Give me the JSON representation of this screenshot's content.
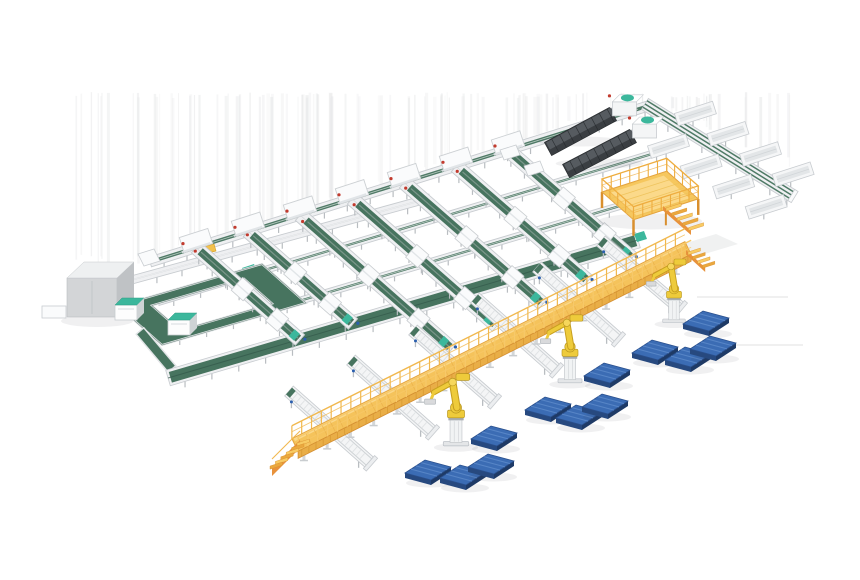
{
  "meta": {
    "canvas_width": 860,
    "canvas_height": 580,
    "background": "#ffffff"
  },
  "palette": {
    "belt_green": "#47745f",
    "belt_green_dark": "#33584a",
    "belt_green_mid": "#3f6a56",
    "teal": "#3cb79c",
    "teal_dark": "#2d9a82",
    "frame_white": "#eff0f2",
    "frame_light": "#fafbfc",
    "frame_stroke": "#c8ccd0",
    "leg_gray": "#b9bdc1",
    "rail_gray": "#d8dbde",
    "roller_gray": "#dfe2e4",
    "walkway_yellow": "#f5c35b",
    "walkway_edge": "#e3a33f",
    "walkway_light": "#fbda8e",
    "walkway_skirt": "#e9ae47",
    "walkway_skirt_line": "#d99b33",
    "stair_orange": "#e8923c",
    "robot_yellow": "#eecb3b",
    "robot_deep": "#c79f1f",
    "robot_outline": "#b8961f",
    "robot_joint": "#f6d75c",
    "pallet_blue": "#3b6cb4",
    "pallet_blue_light": "#5c8aca",
    "pallet_side": "#27497f",
    "pallet_side_dark": "#1e3a66",
    "loader_dark": "#3a3e42",
    "loader_top": "#565b60",
    "loader_line": "#24282b",
    "cabinet_gray": "#d3d5d7",
    "cabinet_top": "#eef0f1",
    "cabinet_side": "#bfc2c5",
    "dot_red": "#c23b2e",
    "dot_blue": "#2b5fae",
    "streak": "#e7e8e9",
    "floor_line": "#dcdcdc",
    "shadow_patch": "#f0f1f1",
    "soft_shadow": "rgba(60,70,80,0.08)"
  },
  "scene": {
    "iso": {
      "u": [
        0.952,
        -0.306
      ],
      "v": [
        0.75,
        0.66
      ]
    },
    "streaks": {
      "seed": 13,
      "count": 120,
      "x_min": 62,
      "x_max": 790,
      "y_top": 92
    },
    "trunks": [
      {
        "p1": [
          150,
          262
        ],
        "p2": [
          648,
          106
        ],
        "w": 10,
        "green": 3.5,
        "leg_step": 24,
        "leg_len": 6
      },
      {
        "p1": [
          158,
          302
        ],
        "p2": [
          672,
          148
        ],
        "w": 7,
        "green": 2.2,
        "leg_step": 28,
        "leg_len": 5
      },
      {
        "p1": [
          164,
          341
        ],
        "p2": [
          640,
          200
        ],
        "w": 7,
        "green": 2.2,
        "leg_step": 28,
        "leg_len": 5
      },
      {
        "p1": [
          117,
          284
        ],
        "p2": [
          430,
          198
        ],
        "w": 8,
        "green": 0,
        "leg_step": 26,
        "leg_len": 6
      }
    ],
    "t3": {
      "p1": [
        168,
        378
      ],
      "p2": [
        638,
        240
      ],
      "w": 16,
      "leg_step": 28
    },
    "loop": {
      "corners": [
        [
          118,
          306
        ],
        [
          262,
          264
        ],
        [
          306,
          303
        ],
        [
          162,
          345
        ]
      ],
      "band": 11
    },
    "bridge": {
      "p1": [
        140,
        331
      ],
      "p2": [
        172,
        369
      ],
      "w": 10
    },
    "teal_cabinets": [
      [
        115,
        305
      ],
      [
        168,
        320
      ]
    ],
    "cabinet": {
      "x": 67,
      "y": 278,
      "w": 50,
      "h": 39,
      "dx": 17,
      "dy": 16
    },
    "stub": {
      "x": 42,
      "y": 306,
      "w": 24,
      "h": 12
    },
    "yellow_box": [
      203,
      247
    ],
    "lanes": [
      {
        "h": [
          196,
          247.6
        ],
        "e": [
          300,
          340
        ]
      },
      {
        "h": [
          248,
          231.3
        ],
        "e": [
          353,
          324
        ]
      },
      {
        "h": [
          300,
          215.1
        ],
        "e": [
          452,
          349
        ]
      },
      {
        "h": [
          352,
          198.8
        ],
        "e": [
          497,
          326
        ]
      },
      {
        "h": [
          404,
          182.6
        ],
        "e": [
          543,
          304
        ]
      },
      {
        "h": [
          456,
          166.3
        ],
        "e": [
          588,
          281
        ]
      },
      {
        "h": [
          508,
          150.0
        ],
        "e": [
          632,
          258
        ]
      }
    ],
    "modules_small": [
      [
        500,
        150
      ],
      [
        524,
        166
      ]
    ],
    "loaders": [
      {
        "tail": [
          548,
          149
        ],
        "head": [
          613,
          114
        ]
      },
      {
        "tail": [
          566,
          171
        ],
        "head": [
          633,
          136
        ]
      }
    ],
    "spine": {
      "p1": [
        645,
        104
      ],
      "p2": [
        793,
        196
      ],
      "w": 13,
      "tracks": 3
    },
    "troughs": {
      "upper_t": [
        0.3,
        0.52,
        0.74,
        0.96
      ],
      "lower_t": [
        0.24,
        0.46,
        0.68,
        0.9
      ],
      "len": 40,
      "w": 13,
      "up_off": [
        6,
        -18
      ],
      "low_off": [
        -12,
        20
      ]
    },
    "platform": {
      "a": [
        602,
        192
      ],
      "ulen": 68,
      "vlen": 42,
      "rail_h": 13,
      "leg_h": 16
    },
    "walkway": {
      "p1": [
        295,
        445
      ],
      "p2": [
        688,
        248
      ],
      "w": 14,
      "rail_h": 13,
      "leg_h": 20,
      "skirt": 7
    },
    "spurs": [
      [
        289,
        391,
        369,
        462
      ],
      [
        351,
        360,
        431,
        431
      ],
      [
        413,
        330,
        493,
        400
      ],
      [
        475,
        298,
        555,
        369
      ],
      [
        537,
        267,
        617,
        338
      ],
      [
        601,
        241,
        679,
        307
      ]
    ],
    "robots": [
      {
        "b": [
          456,
          445
        ],
        "s": 0.85
      },
      {
        "b": [
          570,
          382
        ],
        "s": 0.8
      },
      {
        "b": [
          674,
          322
        ],
        "s": 0.75
      }
    ],
    "pallets": [
      [
        494,
        436
      ],
      [
        428,
        470
      ],
      [
        463,
        475
      ],
      [
        491,
        464
      ],
      [
        548,
        407
      ],
      [
        579,
        415
      ],
      [
        605,
        404
      ],
      [
        607,
        373
      ],
      [
        706,
        321
      ],
      [
        655,
        350
      ],
      [
        688,
        357
      ],
      [
        713,
        346
      ]
    ],
    "floor_lines": [
      [
        697,
        297,
        788,
        297
      ],
      [
        719,
        345,
        803,
        345
      ]
    ],
    "shadow_patch": [
      [
        676,
        246
      ],
      [
        716,
        234
      ],
      [
        738,
        244
      ],
      [
        698,
        256
      ]
    ]
  }
}
